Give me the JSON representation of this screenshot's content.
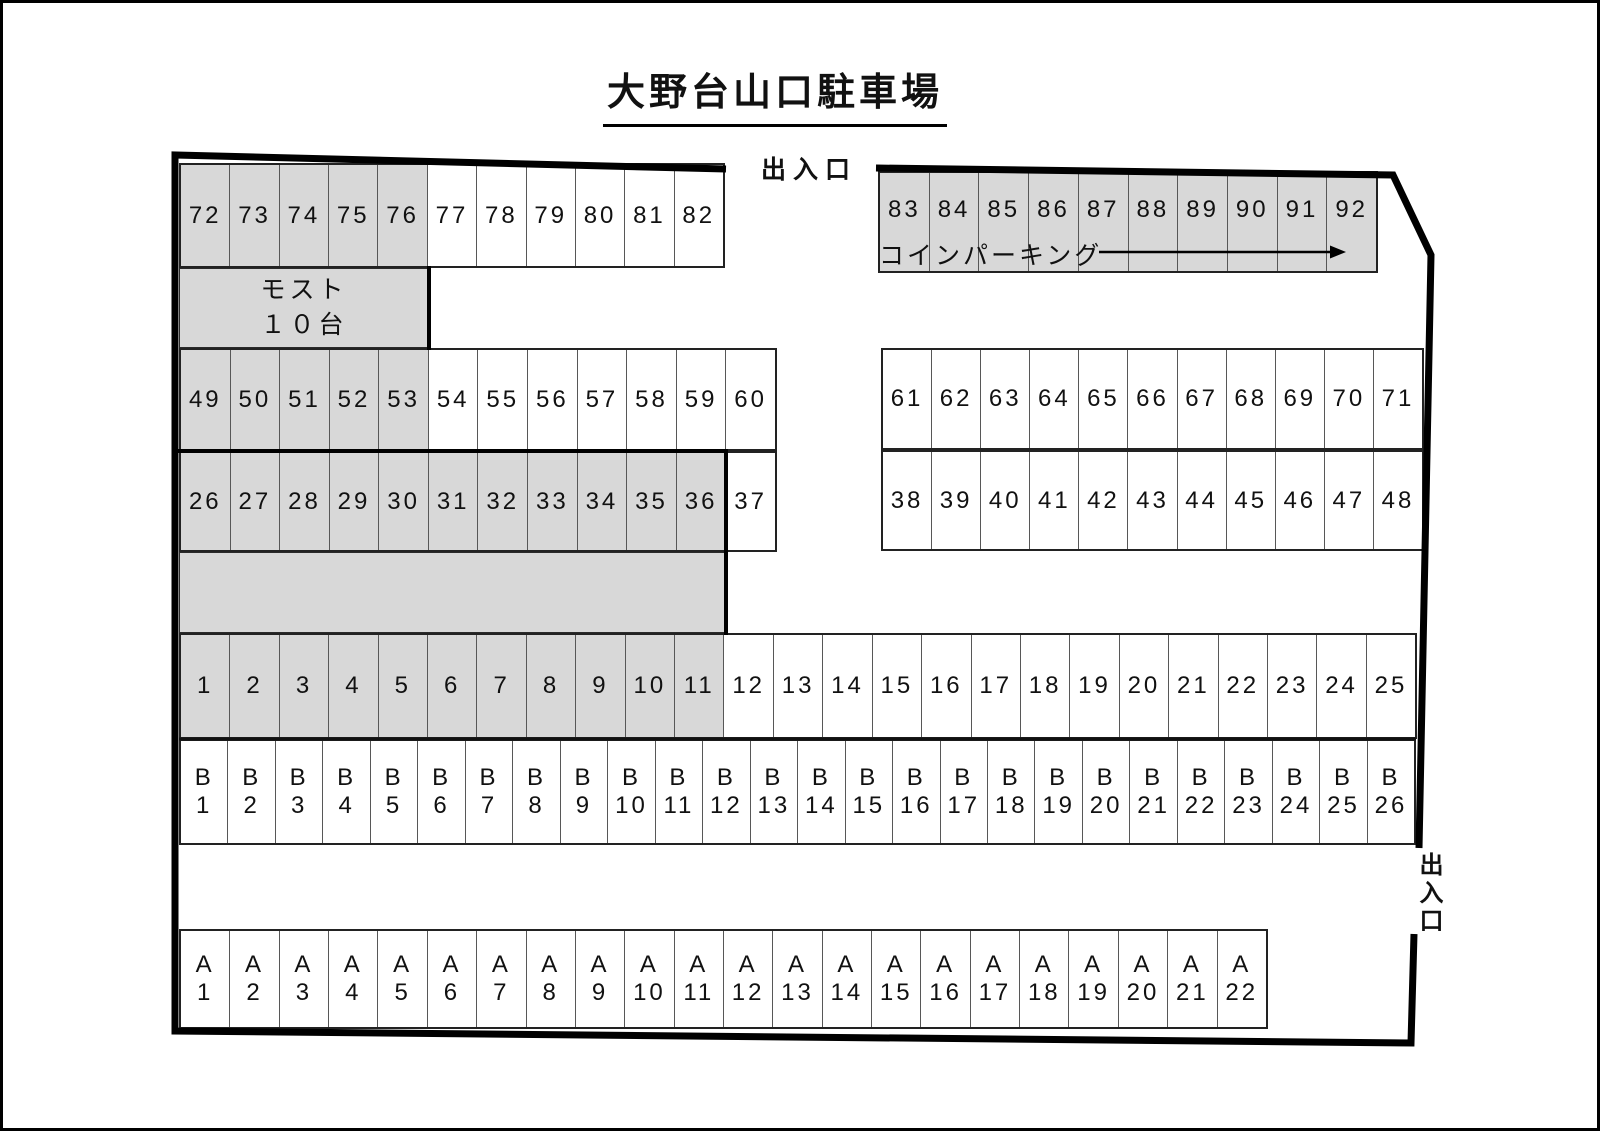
{
  "title": "大野台山口駐車場",
  "labels": {
    "entrance_top": "出入口",
    "entrance_right": "出入口",
    "coin_parking": "コインパーキング"
  },
  "colors": {
    "shaded_fill": "#d8d8d8",
    "vacant_fill": "#ffffff",
    "boundary": "#000000",
    "cell_border": "#575757"
  },
  "rows": [
    {
      "name": "spaces-72-82",
      "x": 176,
      "y": 160,
      "w": 546,
      "h": 105,
      "shaded_first": 5,
      "labels": [
        "72",
        "73",
        "74",
        "75",
        "76",
        "77",
        "78",
        "79",
        "80",
        "81",
        "82"
      ]
    },
    {
      "name": "spaces-83-92",
      "x": 875,
      "y": 168,
      "w": 500,
      "h": 102,
      "shaded_first": 10,
      "pad_bottom": 24,
      "labels": [
        "83",
        "84",
        "85",
        "86",
        "87",
        "88",
        "89",
        "90",
        "91",
        "92"
      ]
    },
    {
      "name": "spaces-49-60",
      "x": 176,
      "y": 345,
      "w": 598,
      "h": 103,
      "shaded_first": 5,
      "labels": [
        "49",
        "50",
        "51",
        "52",
        "53",
        "54",
        "55",
        "56",
        "57",
        "58",
        "59",
        "60"
      ]
    },
    {
      "name": "spaces-61-71",
      "x": 878,
      "y": 345,
      "w": 543,
      "h": 102,
      "shaded_first": 0,
      "labels": [
        "61",
        "62",
        "63",
        "64",
        "65",
        "66",
        "67",
        "68",
        "69",
        "70",
        "71"
      ]
    },
    {
      "name": "spaces-26-37",
      "x": 176,
      "y": 448,
      "w": 598,
      "h": 101,
      "shaded_first": 11,
      "labels": [
        "26",
        "27",
        "28",
        "29",
        "30",
        "31",
        "32",
        "33",
        "34",
        "35",
        "36",
        "37"
      ]
    },
    {
      "name": "spaces-38-48",
      "x": 878,
      "y": 447,
      "w": 543,
      "h": 101,
      "shaded_first": 0,
      "labels": [
        "38",
        "39",
        "40",
        "41",
        "42",
        "43",
        "44",
        "45",
        "46",
        "47",
        "48"
      ]
    },
    {
      "name": "spaces-1-25",
      "x": 176,
      "y": 630,
      "w": 1238,
      "h": 106,
      "shaded_first": 11,
      "labels": [
        "1",
        "2",
        "3",
        "4",
        "5",
        "6",
        "7",
        "8",
        "9",
        "10",
        "11",
        "12",
        "13",
        "14",
        "15",
        "16",
        "17",
        "18",
        "19",
        "20",
        "21",
        "22",
        "23",
        "24",
        "25"
      ]
    },
    {
      "name": "spaces-B1-B26",
      "x": 176,
      "y": 736,
      "w": 1237,
      "h": 106,
      "shaded_first": 0,
      "labels": [
        "B\n1",
        "B\n2",
        "B\n3",
        "B\n4",
        "B\n5",
        "B\n6",
        "B\n7",
        "B\n8",
        "B\n9",
        "B\n10",
        "B\n11",
        "B\n12",
        "B\n13",
        "B\n14",
        "B\n15",
        "B\n16",
        "B\n17",
        "B\n18",
        "B\n19",
        "B\n20",
        "B\n21",
        "B\n22",
        "B\n23",
        "B\n24",
        "B\n25",
        "B\n26"
      ]
    },
    {
      "name": "spaces-A1-A22",
      "x": 176,
      "y": 926,
      "w": 1089,
      "h": 100,
      "shaded_first": 0,
      "labels": [
        "A\n1",
        "A\n2",
        "A\n3",
        "A\n4",
        "A\n5",
        "A\n6",
        "A\n7",
        "A\n8",
        "A\n9",
        "A\n10",
        "A\n11",
        "A\n12",
        "A\n13",
        "A\n14",
        "A\n15",
        "A\n16",
        "A\n17",
        "A\n18",
        "A\n19",
        "A\n20",
        "A\n21",
        "A\n22"
      ]
    }
  ],
  "blocks": [
    {
      "name": "most-block",
      "x": 176,
      "y": 265,
      "w": 250,
      "h": 80,
      "shaded": true,
      "text": "モスト\n１０台"
    },
    {
      "name": "reserved-gray-block",
      "x": 176,
      "y": 549,
      "w": 547,
      "h": 81,
      "shaded": true,
      "text": ""
    }
  ]
}
